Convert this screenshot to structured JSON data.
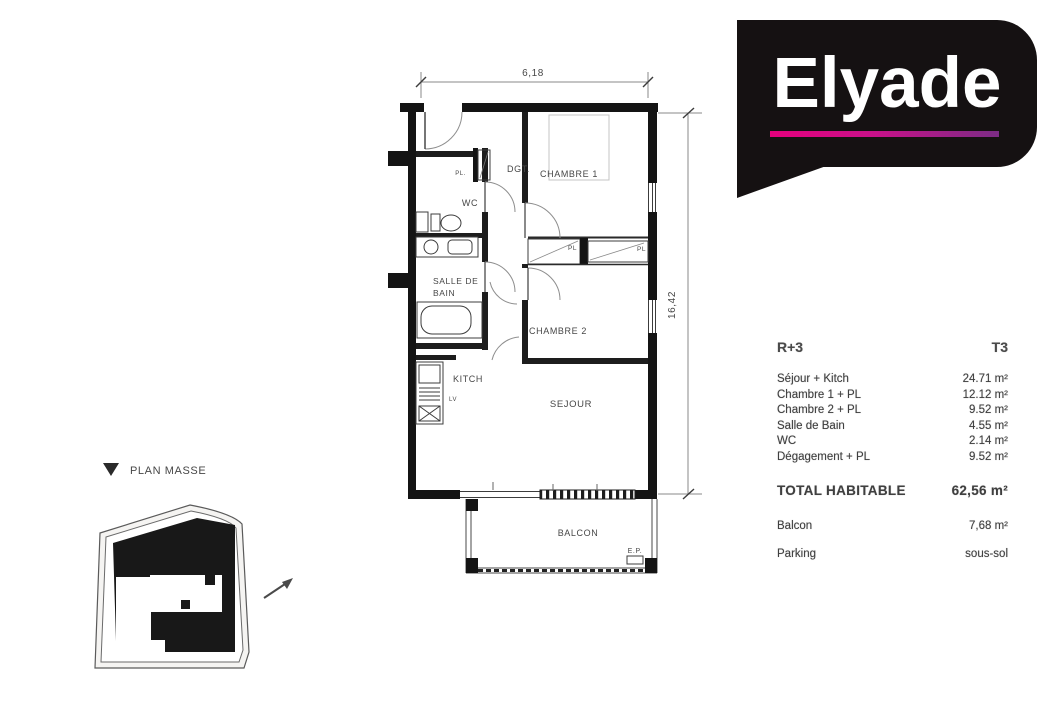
{
  "logo": {
    "text": "Elyade",
    "bubble_color": "#151112",
    "underline_gradient": [
      "#e5007d",
      "#7c2c85"
    ]
  },
  "floor_plan": {
    "dim_top": "6,18",
    "dim_right": "16,42",
    "labels": {
      "dgt": "DGT.",
      "pl_entry": "PL.",
      "chambre1": "CHAMBRE 1",
      "wc": "WC",
      "salle_de_bain_1": "SALLE DE",
      "salle_de_bain_2": "BAIN",
      "pl_left": "PL",
      "pl_right": "PL",
      "chambre2": "CHAMBRE 2",
      "kitch": "KITCH",
      "lv": "LV",
      "sejour": "SEJOUR",
      "balcon": "BALCON",
      "ep": "E.P."
    }
  },
  "site_plan": {
    "title": "PLAN MASSE"
  },
  "summary": {
    "level": "R+3",
    "unit_type": "T3",
    "rows": [
      {
        "label": "Séjour + Kitch",
        "value": "24.71 m²"
      },
      {
        "label": "Chambre 1 + PL",
        "value": "12.12 m²"
      },
      {
        "label": "Chambre 2 + PL",
        "value": "9.52 m²"
      },
      {
        "label": "Salle de Bain",
        "value": "4.55 m²"
      },
      {
        "label": "WC",
        "value": "2.14 m²"
      },
      {
        "label": "Dégagement + PL",
        "value": "9.52 m²"
      }
    ],
    "total": {
      "label": "TOTAL HABITABLE",
      "value": "62,56 m²"
    },
    "balcon": {
      "label": "Balcon",
      "value": "7,68 m²"
    },
    "parking": {
      "label": "Parking",
      "value": "sous-sol"
    }
  }
}
